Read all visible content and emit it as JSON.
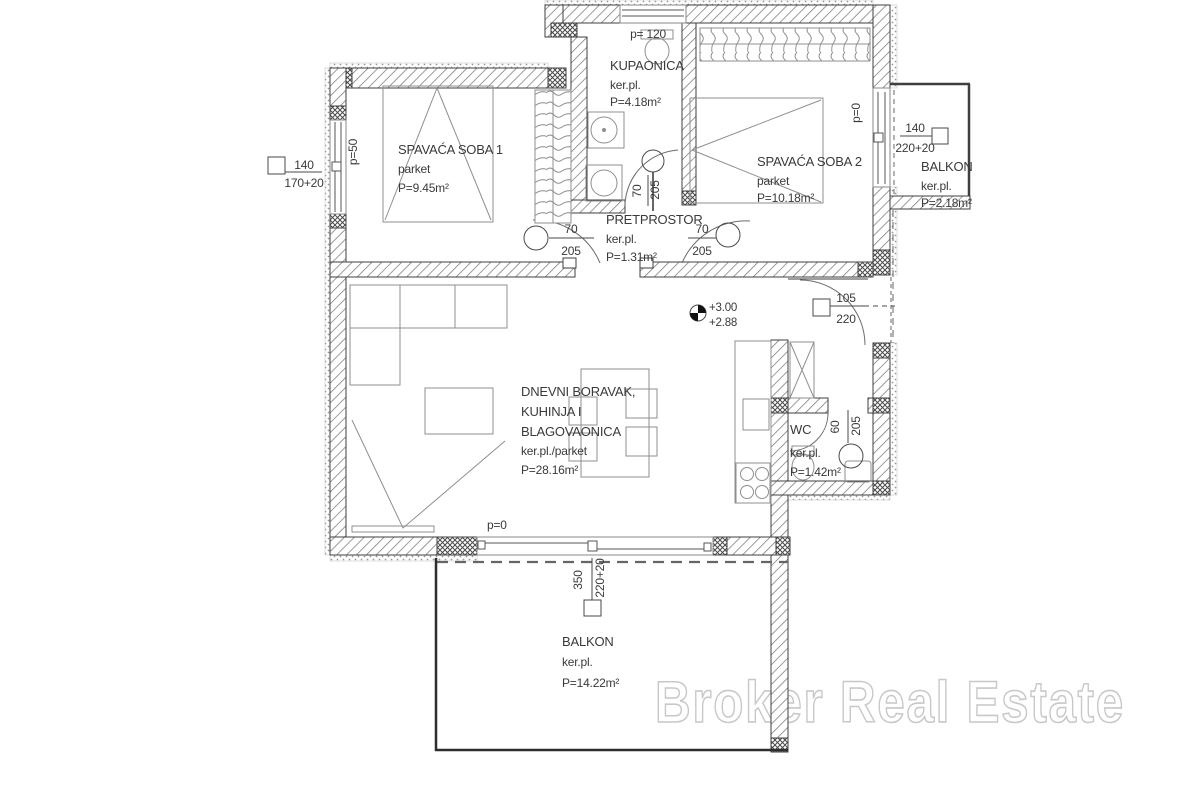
{
  "meta": {
    "watermark": "Broker Real Estate"
  },
  "palette": {
    "line": "#3f3f3f",
    "wall_hatch": "#7a7a7a",
    "text": "#3a3a3a",
    "watermark_stroke": "#c8c8c8",
    "background": "#ffffff"
  },
  "rooms": {
    "bedroom1": {
      "name": "SPAVAĆA SOBA 1",
      "floor": "parket",
      "area": "P=9.45m²"
    },
    "bathroom": {
      "name": "KUPAONICA",
      "floor": "ker.pl.",
      "area": "P=4.18m²"
    },
    "bedroom2": {
      "name": "SPAVAĆA SOBA 2",
      "floor": "parket",
      "area": "P=10.18m²"
    },
    "balcony_right": {
      "name": "BALKON",
      "floor": "ker.pl.",
      "area": "P=2.18m²"
    },
    "hallway": {
      "name": "PRETPROSTOR",
      "floor": "ker.pl.",
      "area": "P=1.31m²"
    },
    "living": {
      "name_line1": "DNEVNI BORAVAK,",
      "name_line2": "KUHINJA I",
      "name_line3": "BLAGOVAONICA",
      "floor": "ker.pl./parket",
      "area": "P=28.16m²"
    },
    "wc": {
      "name": "WC",
      "floor": "ker.pl.",
      "area": "P=1.42m²"
    },
    "balcony_bottom": {
      "name": "BALKON",
      "floor": "ker.pl.",
      "area": "P=14.22m²"
    }
  },
  "openings": {
    "window_top": {
      "parapet": "p= 120"
    },
    "window_left": {
      "width": "140",
      "height": "170+20",
      "parapet": "p=50"
    },
    "window_right": {
      "width": "140",
      "height": "220+20",
      "parapet": "p=0"
    },
    "window_bottom": {
      "width": "350",
      "height": "220+20",
      "parapet": "p=0"
    },
    "door_bathroom": {
      "width": "70",
      "height": "205"
    },
    "door_bedroom1": {
      "width": "70",
      "height": "205"
    },
    "door_bedroom2": {
      "width": "70",
      "height": "205"
    },
    "door_entry": {
      "width": "105",
      "height": "220"
    },
    "door_wc": {
      "width": "60",
      "height": "205"
    }
  },
  "levels": {
    "upper": "+3.00",
    "lower": "+2.88"
  }
}
